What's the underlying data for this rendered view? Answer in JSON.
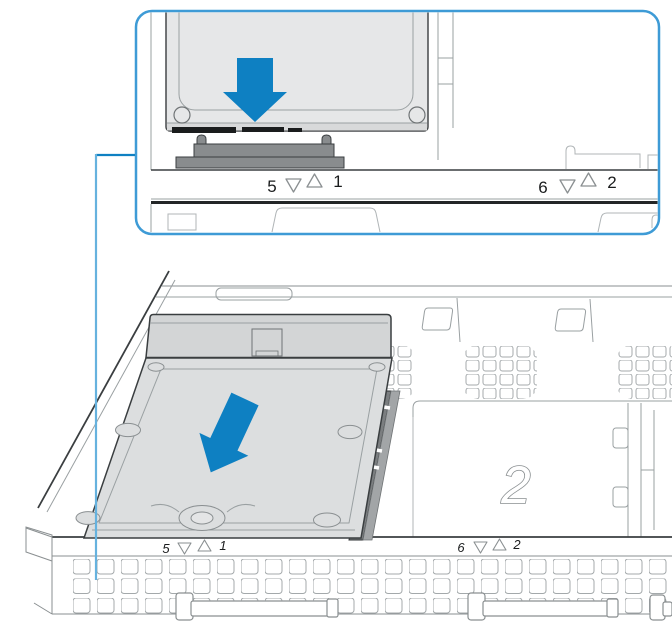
{
  "colors": {
    "arrow_blue": "#0e80c2",
    "inset_border": "#3e9bd6",
    "callout_vertical": "#66b2de",
    "callout_elbow": "#0e80c2"
  },
  "inset": {
    "bay5": "5",
    "bay1": "1",
    "bay6": "6",
    "bay2": "2"
  },
  "main_view": {
    "bay5": "5",
    "bay1": "1",
    "bay6": "6",
    "bay2": "2",
    "bay2_number": "2"
  }
}
